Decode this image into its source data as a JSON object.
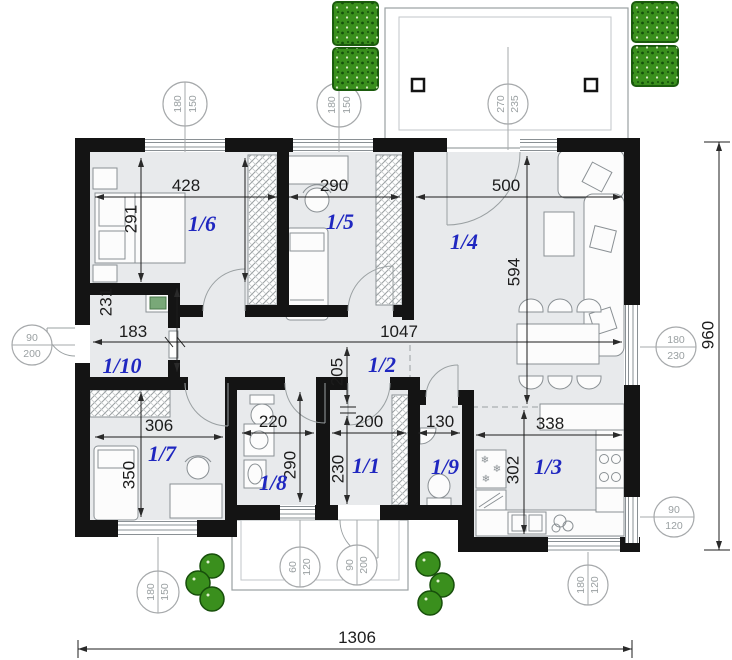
{
  "colors": {
    "wall": "#141414",
    "floor": "#e8eaec",
    "label_blue": "#1f27c0",
    "dim_text": "#1c1c1c",
    "outline_gray": "#8a9094",
    "bush_green": "#3a8f1d"
  },
  "rooms": {
    "r1": {
      "label": "1/1"
    },
    "r2": {
      "label": "1/2"
    },
    "r3": {
      "label": "1/3"
    },
    "r4": {
      "label": "1/4"
    },
    "r5": {
      "label": "1/5"
    },
    "r6": {
      "label": "1/6"
    },
    "r7": {
      "label": "1/7"
    },
    "r8": {
      "label": "1/8"
    },
    "r9": {
      "label": "1/9"
    },
    "r10": {
      "label": "1/10"
    }
  },
  "dims": {
    "room6_w": "428",
    "room6_h": "291",
    "room5_w": "290",
    "room4_w": "500",
    "room4_h": "594",
    "entry_w": "183",
    "hall_w": "1047",
    "hall_h": "205",
    "room10_h": "231",
    "room7_w": "306",
    "room7_h": "350",
    "room8_w": "220",
    "room8_h": "290",
    "room1_w": "200",
    "room1_h": "230",
    "room9_w": "130",
    "room3_w": "338",
    "room3_h": "302",
    "total_w": "1306",
    "total_h": "960"
  },
  "openings": {
    "win_bed6": {
      "w": "180",
      "h": "150"
    },
    "win_bed5": {
      "w": "180",
      "h": "150"
    },
    "terrace_door": {
      "w": "270",
      "h": "235"
    },
    "entry_door": {
      "w": "90",
      "h": "200"
    },
    "living_win": {
      "w": "180",
      "h": "230"
    },
    "kitchen_side_win": {
      "w": "90",
      "h": "120"
    },
    "kitchen_bottom_win": {
      "w": "180",
      "h": "120"
    },
    "bath_win": {
      "w": "60",
      "h": "120"
    },
    "porch_door": {
      "w": "90",
      "h": "200"
    },
    "bed7_win": {
      "w": "180",
      "h": "150"
    }
  }
}
